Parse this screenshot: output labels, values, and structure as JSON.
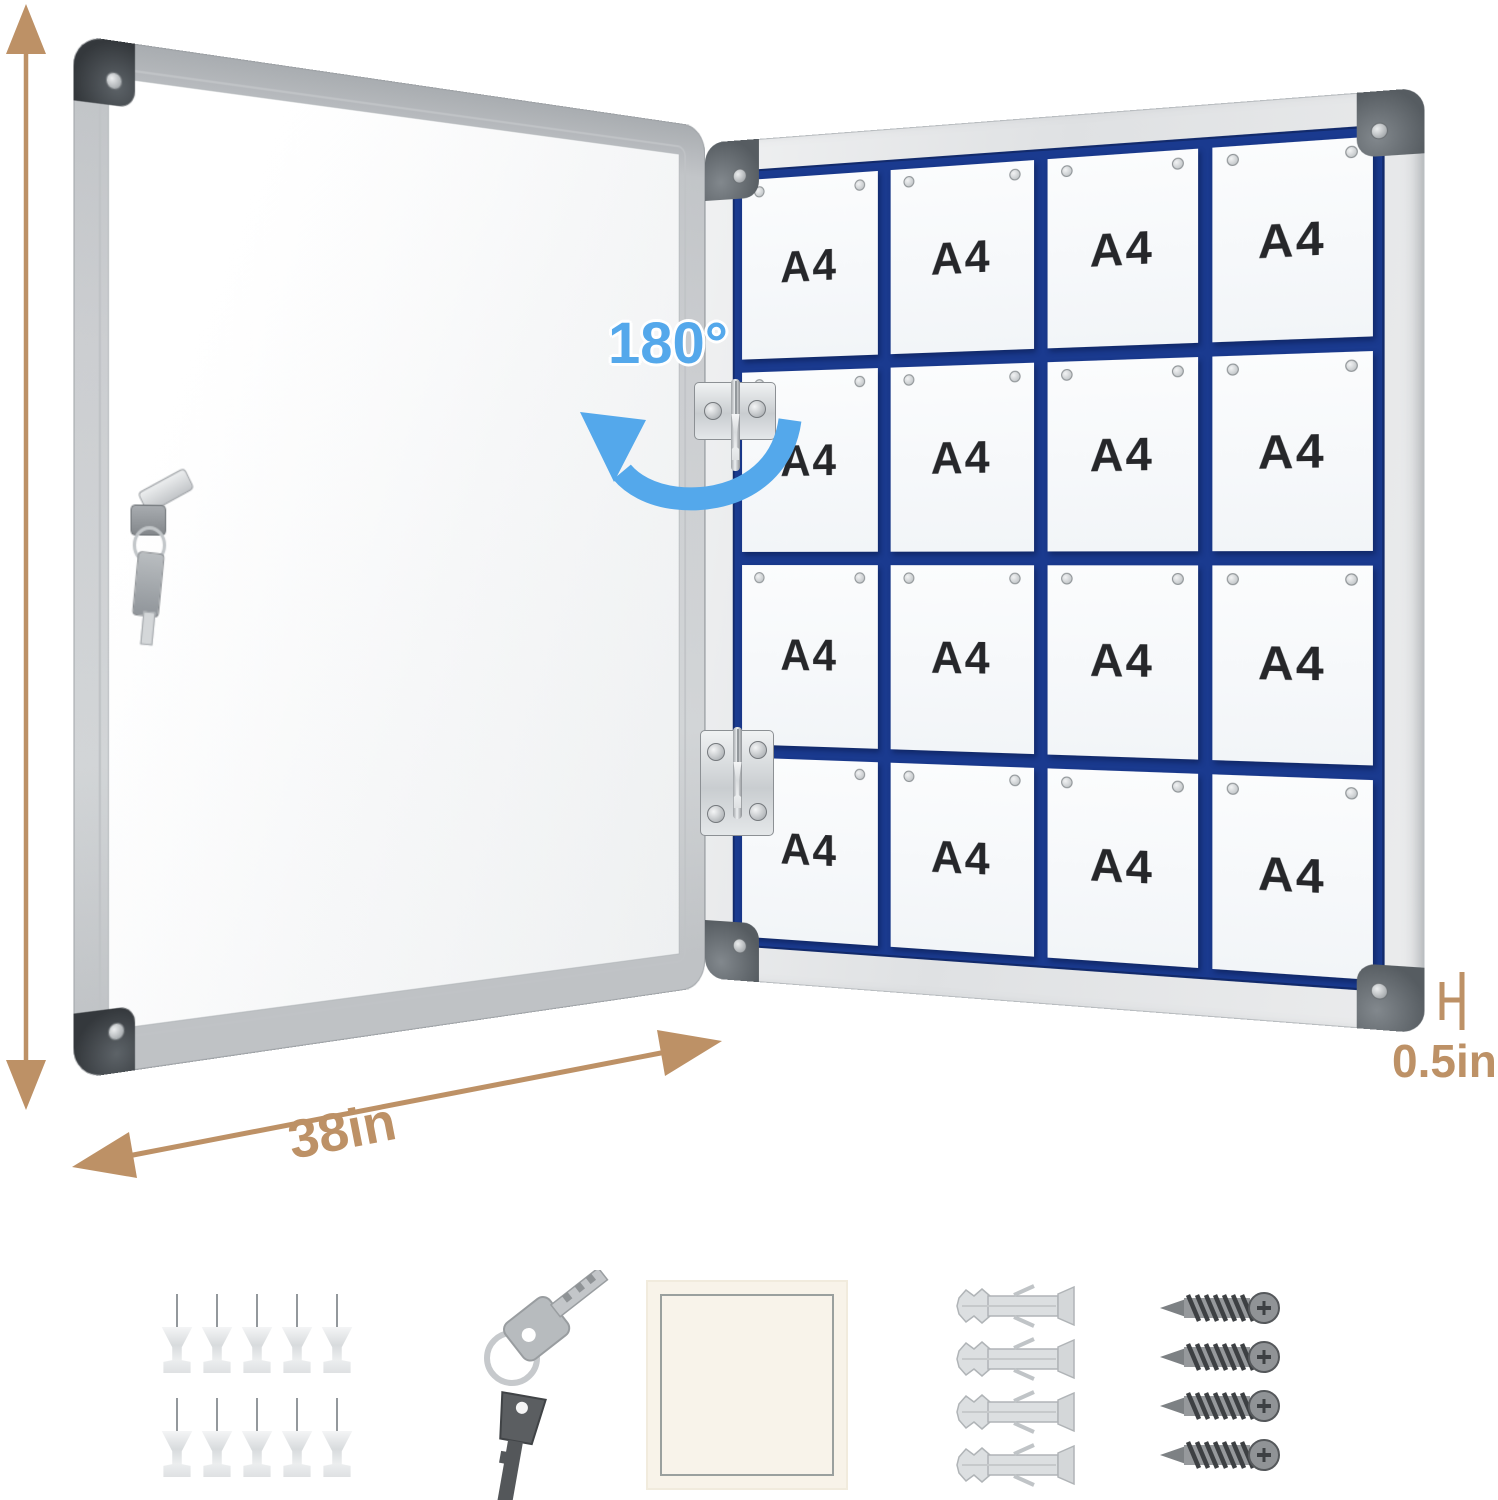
{
  "annotations": {
    "height_label": "38in",
    "width_label": "38in",
    "depth_label": "0.5in",
    "rotation_label": "180°"
  },
  "board": {
    "cells": [
      "A4",
      "A4",
      "A4",
      "A4",
      "A4",
      "A4",
      "A4",
      "A4",
      "A4",
      "A4",
      "A4",
      "A4",
      "A4",
      "A4",
      "A4",
      "A4"
    ]
  },
  "accessories": {
    "push_pin_count": 10,
    "key_count": 2,
    "wall_anchor_count": 4,
    "screw_count": 4
  },
  "colors": {
    "dimension_tan": "#BD9166",
    "rotation_blue": "#54A8EB",
    "grid_navy": "#1A3A8F",
    "paper_white": "#F6F8FB",
    "frame_aluminum": "#D6D9DB"
  }
}
